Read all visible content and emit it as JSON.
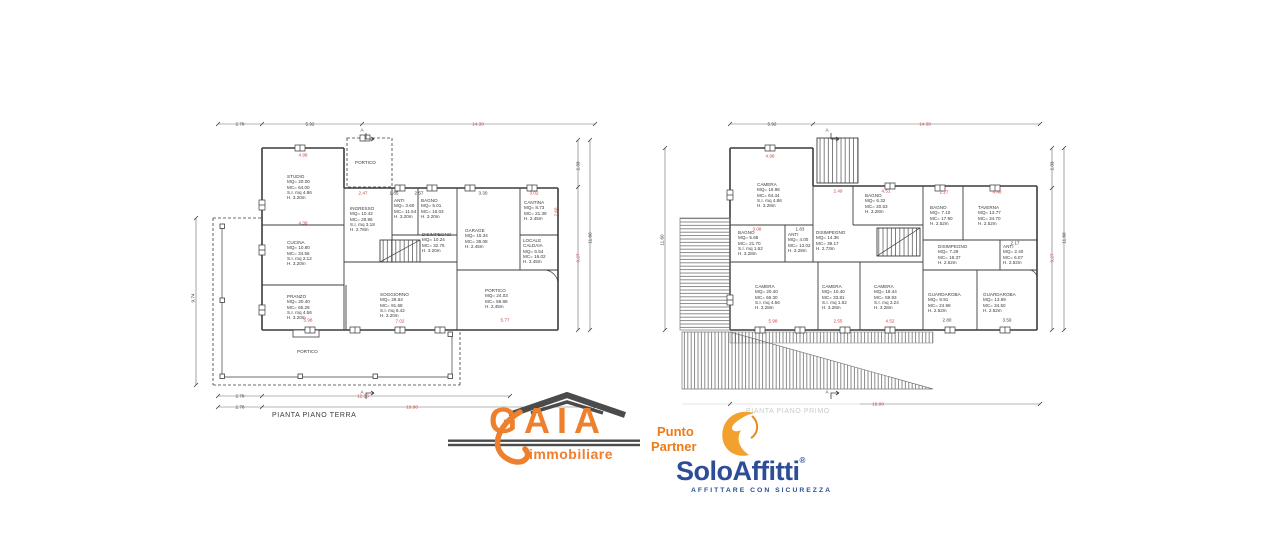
{
  "meta": {
    "background": "#ffffff",
    "line_color": "#3c3c3c",
    "dim_red": "#cc4444",
    "faded_gray": "#cbcbcb"
  },
  "terra": {
    "caption": "PIANTA PIANO TERRA",
    "section_marker": "A",
    "rooms": [
      {
        "id": "studio",
        "lines": [
          "STUDIO",
          "MQ= 20.00",
          "MC= 64.00",
          "S.I. mq 4.86",
          "H. 3.20m"
        ]
      },
      {
        "id": "cucina",
        "lines": [
          "CUCINA",
          "MQ= 10.80",
          "MC= 34.56",
          "S.I. mq 2.12",
          "H. 3.20m"
        ]
      },
      {
        "id": "pranzo",
        "lines": [
          "PRANZO",
          "MQ= 20.40",
          "MC= 65.28",
          "S.I. mq 4.56",
          "H. 3.20m"
        ]
      },
      {
        "id": "soggiorno",
        "lines": [
          "SOGGIORNO",
          "MQ= 28.64",
          "MC= 91.68",
          "S.I. mq 6.42",
          "H. 3.20m"
        ]
      },
      {
        "id": "ingresso",
        "lines": [
          "INGRESSO",
          "MQ= 10.42",
          "MC= 28.96",
          "S.I. mq 3.18",
          "H. 2.78m"
        ]
      },
      {
        "id": "anti",
        "lines": [
          "ANTI",
          "MQ= 3.60",
          "MC= 11.54",
          "H. 3.20m"
        ]
      },
      {
        "id": "bagno",
        "lines": [
          "BAGNO",
          "MQ= 5.01",
          "MC= 16.03",
          "H. 3.20m"
        ]
      },
      {
        "id": "disimpegno",
        "lines": [
          "DISIMPEGNO",
          "MQ= 10.24",
          "MC= 32.76",
          "H. 3.20m"
        ]
      },
      {
        "id": "garage",
        "lines": [
          "GARAGE",
          "MQ= 15.34",
          "MC= 39.08",
          "H. 2.45m"
        ]
      },
      {
        "id": "cantina",
        "lines": [
          "CANTINA",
          "MQ= 8.73",
          "MC= 21.39",
          "H. 2.45m"
        ]
      },
      {
        "id": "locale-caldaia",
        "lines": [
          "LOCALE",
          "CALDAIA",
          "MQ= 6.54",
          "MC= 16.02",
          "H. 2.45m"
        ]
      },
      {
        "id": "portico-est",
        "lines": [
          "PORTICO",
          "MQ= 24.03",
          "MC= 58.88",
          "H. 2.45m"
        ]
      },
      {
        "id": "portico-nord",
        "lines": [
          "PORTICO"
        ]
      },
      {
        "id": "portico-sud",
        "lines": [
          "PORTICO"
        ]
      }
    ],
    "dims": {
      "top1": "2.78",
      "top2": "5.92",
      "top3": "14.38",
      "studio": "4.98",
      "ingresso": "2.47",
      "cucina": "4.38",
      "anti": "1.85",
      "bagno": "2.57",
      "garage": "3.30",
      "cantina": "3.02",
      "cantina_v": "2.60",
      "pranzo": "5.98",
      "soggiorno": "7.02",
      "portico": "5.77",
      "bottom1a": "2.78",
      "bottom1b": "12.93",
      "bottom2a": "2.78",
      "bottom2b": "19.98",
      "left": "9.74",
      "right1": "2.33",
      "right2": "9.27",
      "right3": "11.60"
    }
  },
  "primo": {
    "caption": "PIANTA PIANO PRIMO",
    "section_marker": "A",
    "rooms": [
      {
        "id": "camera-1",
        "lines": [
          "CAMERA",
          "MQ= 16.96",
          "MC= 64.34",
          "S.I. mq 4.86",
          "H. 3.28m"
        ]
      },
      {
        "id": "bagno-1",
        "lines": [
          "BAGNO",
          "MQ= 5.68",
          "MC= 21.70",
          "S.I. mq 1.62",
          "H. 3.28m"
        ]
      },
      {
        "id": "anti-1",
        "lines": [
          "ANTI",
          "MQ= 4.00",
          "MC= 13.02",
          "H. 3.28m"
        ]
      },
      {
        "id": "disimpegno-1",
        "lines": [
          "DISIMPEGNO",
          "MQ= 14.36",
          "MC= 39.17",
          "H. 2.73m"
        ]
      },
      {
        "id": "bagno-2",
        "lines": [
          "BAGNO",
          "MQ= 6.32",
          "MC= 20.53",
          "H. 3.28m"
        ]
      },
      {
        "id": "bagno-3",
        "lines": [
          "BAGNO",
          "MQ= 7.10",
          "MC= 17.90",
          "H. 2.52m"
        ]
      },
      {
        "id": "taverna",
        "lines": [
          "TAVERNA",
          "MQ= 13.77",
          "MC= 34.70",
          "H. 2.52m"
        ]
      },
      {
        "id": "disimpegno-2",
        "lines": [
          "DISIMPEGNO",
          "MQ= 7.29",
          "MC= 18.37",
          "H. 2.52m"
        ]
      },
      {
        "id": "anti-2",
        "lines": [
          "ANTI",
          "MQ= 2.40",
          "MC= 6.07",
          "H. 2.52m"
        ]
      },
      {
        "id": "camera-2",
        "lines": [
          "CAMERA",
          "MQ= 20.40",
          "MC= 66.30",
          "S.I. mq 4.56",
          "H. 3.28m"
        ]
      },
      {
        "id": "camera-3",
        "lines": [
          "CAMERA",
          "MQ= 10.40",
          "MC= 33.81",
          "S.I. mq 1.62",
          "H. 3.28m"
        ]
      },
      {
        "id": "camera-4",
        "lines": [
          "CAMERA",
          "MQ= 18.44",
          "MC= 59.93",
          "S.I. mq 3.24",
          "H. 3.28m"
        ]
      },
      {
        "id": "guardaroba-1",
        "lines": [
          "GUARDAROBA",
          "MQ= 9.91",
          "MC= 24.98",
          "H. 2.52m"
        ]
      },
      {
        "id": "guardaroba-2",
        "lines": [
          "GUARDAROBA",
          "MQ= 13.69",
          "MC= 34.50",
          "H. 2.52m"
        ]
      }
    ],
    "dims": {
      "top1": "5.92",
      "top2": "14.38",
      "camera1": "4.98",
      "disimpegno": "2.49",
      "bagno2": "4.51",
      "bagno1": "3.08",
      "anti1": "1.83",
      "bagno3": "2.27",
      "taverna": "4.40",
      "anti2": "2.17",
      "camera2": "5.98",
      "camera3": "2.55",
      "camera4": "4.52",
      "guardaroba1": "2.80",
      "guardaroba2": "3.59",
      "bottom": "19.98",
      "left": "11.60",
      "right1": "2.33",
      "right2": "9.27",
      "right3": "11.60"
    }
  },
  "branding": {
    "gaia": {
      "name": "GAIA",
      "subtitle": "immobiliare",
      "orange": "#ee7f2d",
      "gray": "#4b4b4b"
    },
    "partner": {
      "line1": "Punto",
      "line2": "Partner",
      "color": "#ee7b16"
    },
    "soloaffitti": {
      "name": "SoloAffitti",
      "reg": "®",
      "tagline": "AFFITTARE CON SICUREZZA",
      "blue": "#2d4e97",
      "orange": "#f2a12e"
    }
  }
}
